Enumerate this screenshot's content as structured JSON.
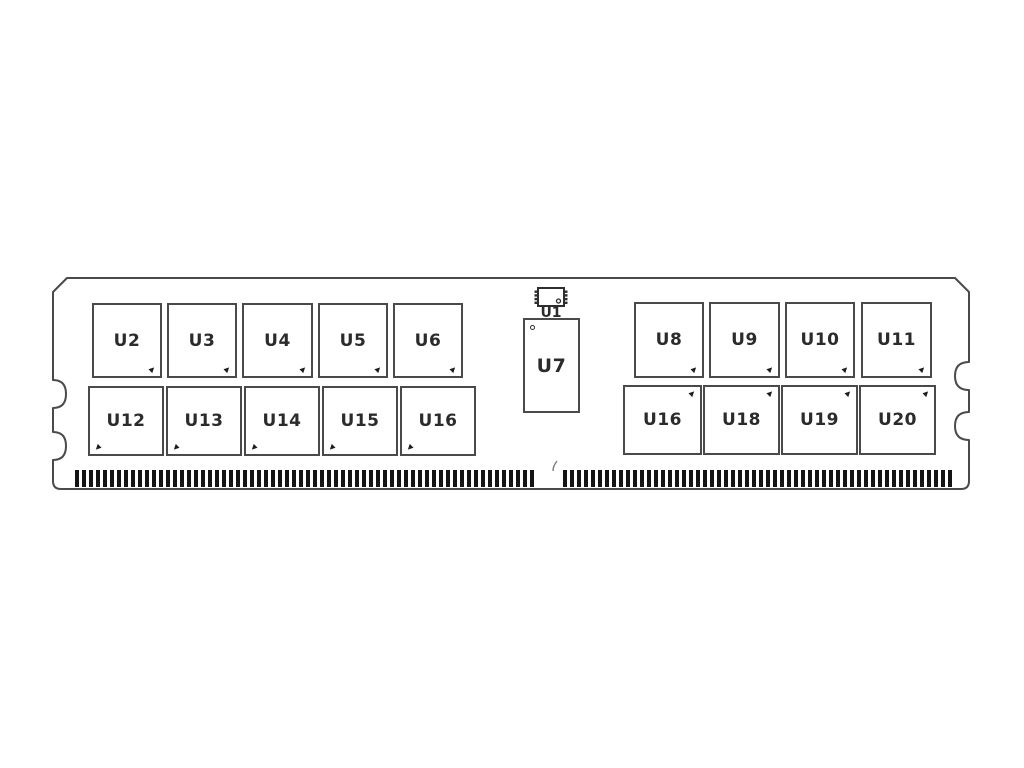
{
  "chips": {
    "left_top": [
      {
        "label": "U2"
      },
      {
        "label": "U3"
      },
      {
        "label": "U4"
      },
      {
        "label": "U5"
      },
      {
        "label": "U6"
      }
    ],
    "left_bottom": [
      {
        "label": "U12"
      },
      {
        "label": "U13"
      },
      {
        "label": "U14"
      },
      {
        "label": "U15"
      },
      {
        "label": "U16"
      }
    ],
    "right_top": [
      {
        "label": "U8"
      },
      {
        "label": "U9"
      },
      {
        "label": "U10"
      },
      {
        "label": "U11"
      }
    ],
    "right_bottom": [
      {
        "label": "U16"
      },
      {
        "label": "U18"
      },
      {
        "label": "U19"
      },
      {
        "label": "U20"
      }
    ],
    "center_small": {
      "label": "U1"
    },
    "center_tall": {
      "label": "U7"
    }
  },
  "connector": {
    "left_pin_count": 66,
    "right_pin_count": 56,
    "pin_pitch_px": 7,
    "pin_width_px": 4,
    "left_run_start_x": 75,
    "right_run_start_x": 563
  },
  "colors": {
    "outline": "#4a4a4a",
    "chip_border": "#4a4a4a",
    "label": "#2b2b2b",
    "pin_fill": "#141414",
    "background": "#ffffff"
  }
}
